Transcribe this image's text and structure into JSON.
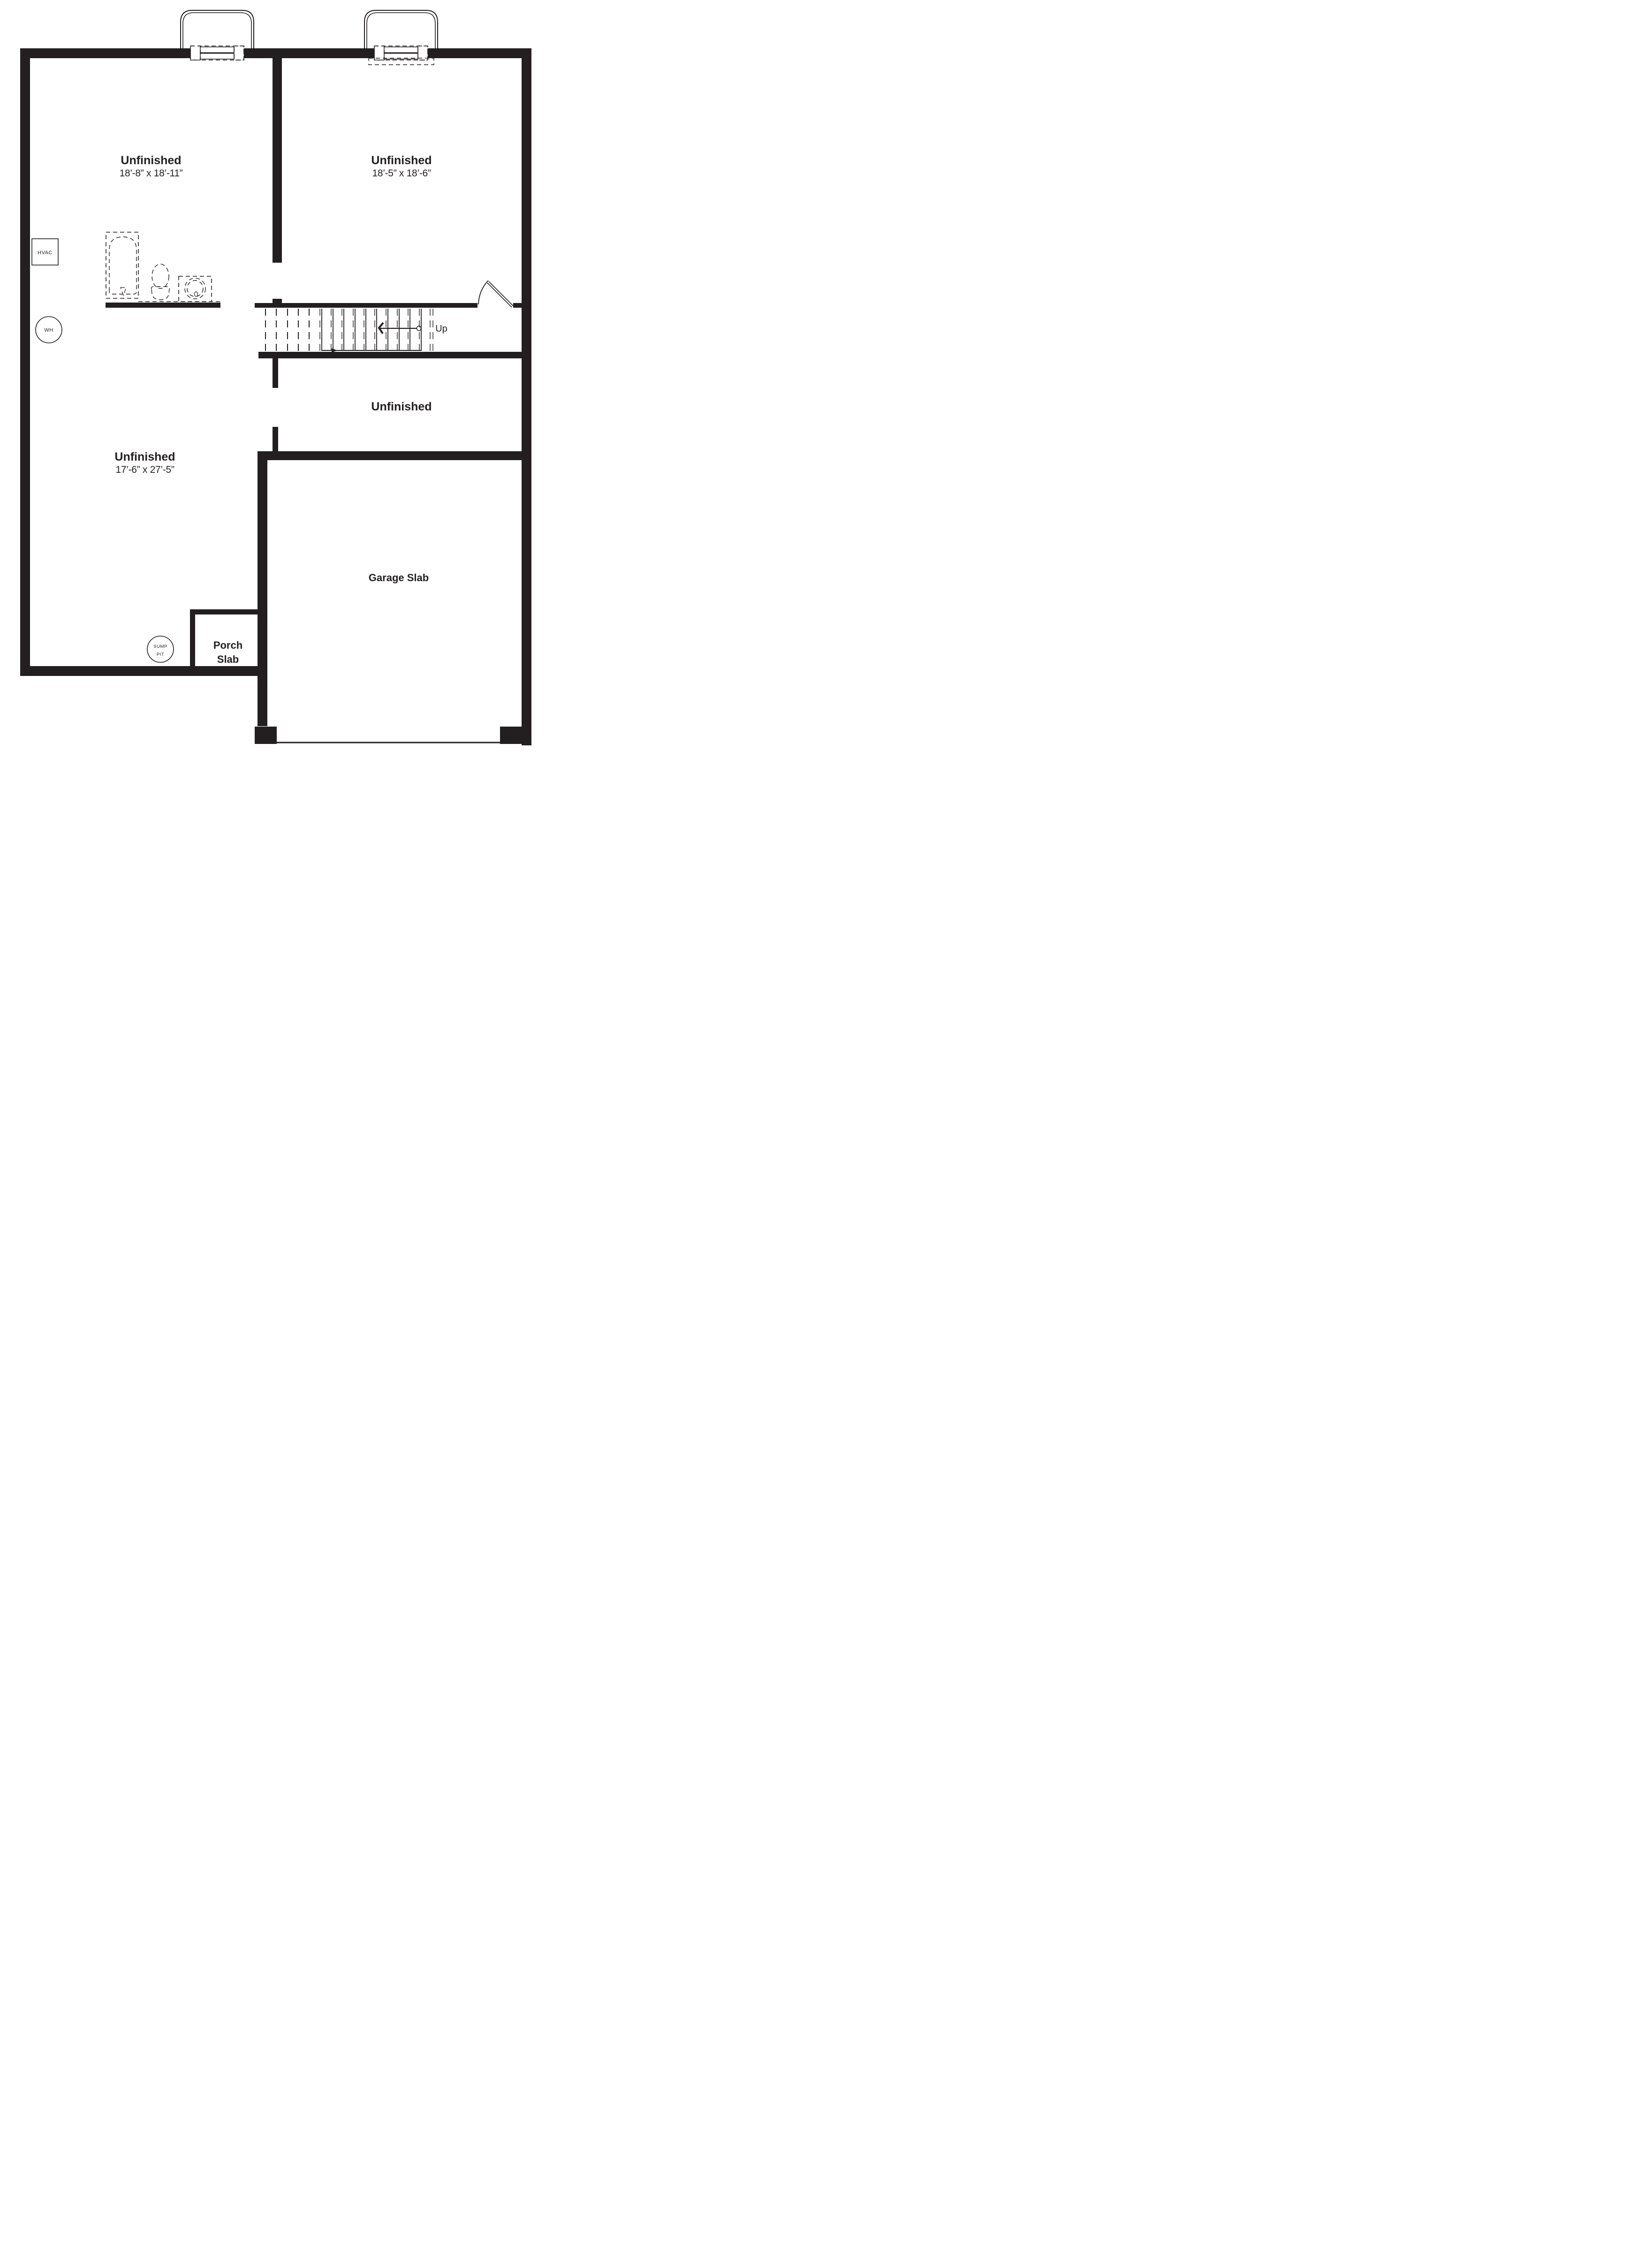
{
  "drawing": {
    "type": "basement-floor-plan",
    "colors": {
      "ink": "#231f20",
      "background": "#ffffff"
    }
  },
  "rooms": {
    "top_left": {
      "name": "Unfinished",
      "dims": "18’-8” x 18’-11”"
    },
    "top_right": {
      "name": "Unfinished",
      "dims": "18’-5” x 18’-6”"
    },
    "middle": {
      "name": "Unfinished"
    },
    "lower_left": {
      "name": "Unfinished",
      "dims": "17’-6” x 27’-5”"
    },
    "garage": {
      "name": "Garage Slab"
    },
    "porch": {
      "line1": "Porch",
      "line2": "Slab"
    }
  },
  "labels": {
    "stairs_direction": "Up",
    "hvac": "HVAC",
    "water_heater": "WH",
    "sump_line1": "SUMP",
    "sump_line2": "PIT"
  }
}
